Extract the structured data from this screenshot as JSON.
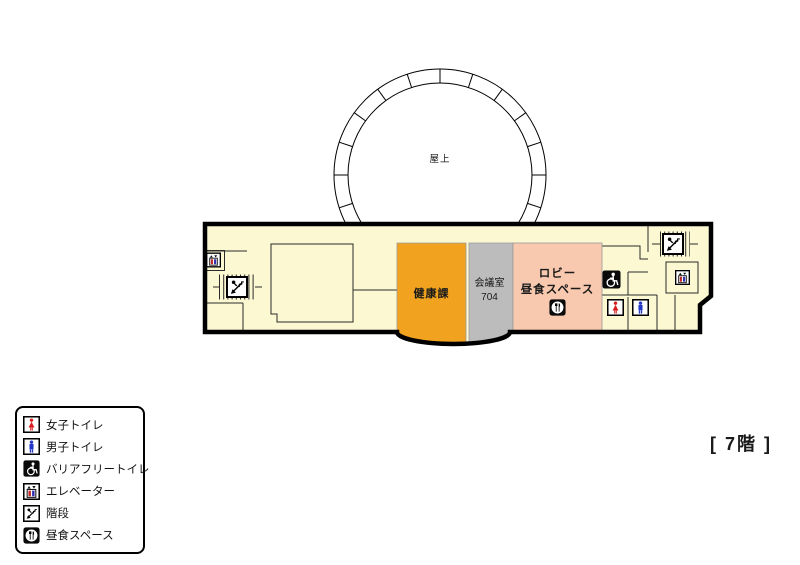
{
  "floor_label": "[ 7階 ]",
  "roof": {
    "label": "屋上"
  },
  "rooms": {
    "health": {
      "label": "健康課",
      "color": "#F1A31F"
    },
    "meeting": {
      "label": "会議室\n704",
      "color": "#BCBCBC"
    },
    "lobby": {
      "label": "ロビー\n昼食スペース",
      "color": "#F8C9AE"
    }
  },
  "legend": {
    "items": [
      {
        "icon": "women-toilet-icon",
        "label": "女子トイレ"
      },
      {
        "icon": "men-toilet-icon",
        "label": "男子トイレ"
      },
      {
        "icon": "barrier-free-toilet-icon",
        "label": "バリアフリートイレ"
      },
      {
        "icon": "elevator-icon",
        "label": "エレベーター"
      },
      {
        "icon": "stairs-icon",
        "label": "階段"
      },
      {
        "icon": "lunch-space-icon",
        "label": "昼食スペース"
      }
    ]
  },
  "colors": {
    "floor_fill": "#FBF8D2",
    "outline": "#000000",
    "health_room": "#F1A31F",
    "meeting_room": "#BCBCBC",
    "lobby_room": "#F8C9AE",
    "women_figure": "#D81E1E",
    "men_figure": "#2438C8",
    "interior_wall": "#2B2B2B"
  }
}
